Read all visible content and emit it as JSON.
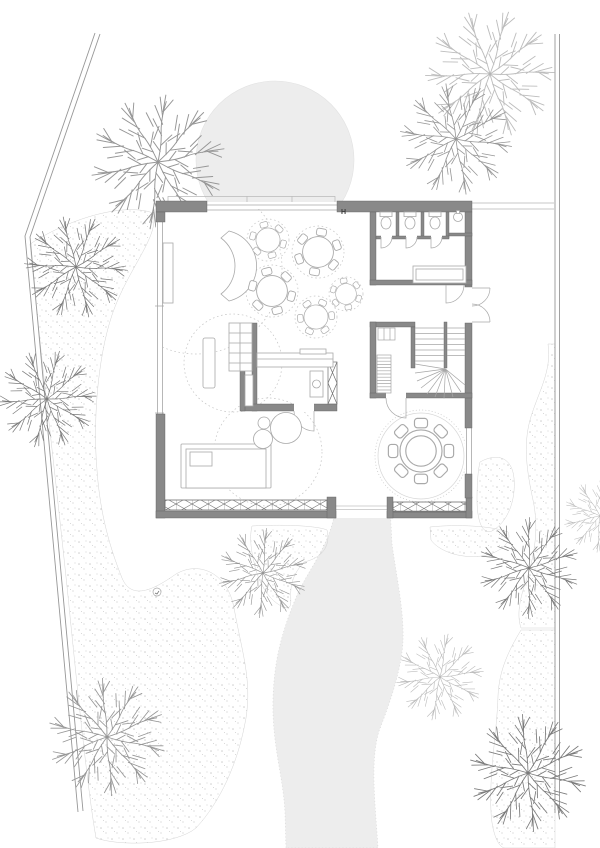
{
  "meta": {
    "drawing_type": "architectural ground-floor site plan",
    "visible_text": [
      "H"
    ]
  },
  "palette": {
    "paper": "#ffffff",
    "boundary": "#979797",
    "line": "#a6a6a6",
    "line_light": "#b5b5b5",
    "wall_fill": "#898989",
    "wall_edge": "#5f5f5f",
    "furniture": "#a9a9a9",
    "rug_dash": "#c4c4c4",
    "ground_fill": "#ededed",
    "stipple_dot": "#c9c9c9",
    "tree_light": "#bdbdbd",
    "tree_medium": "#969696",
    "tree_dark": "#7a7a7a",
    "label": "#3c3c3c"
  },
  "plan": {
    "marker_h": "H",
    "site": {
      "boundary_west": "angled double property line",
      "boundary_east": "vertical double property line",
      "entry_court": "grey circular forecourt at north facade",
      "garden_path": "grey winding path leaving south facade",
      "planting_beds": 6,
      "trees": [
        {
          "x": 158,
          "y": 162,
          "tone": "medium"
        },
        {
          "x": 490,
          "y": 74,
          "tone": "light"
        },
        {
          "x": 456,
          "y": 139,
          "tone": "medium"
        },
        {
          "x": 76,
          "y": 267,
          "tone": "dark"
        },
        {
          "x": 47,
          "y": 399,
          "tone": "dark"
        },
        {
          "x": 263,
          "y": 573,
          "tone": "medium"
        },
        {
          "x": 107,
          "y": 737,
          "tone": "medium"
        },
        {
          "x": 440,
          "y": 677,
          "tone": "light"
        },
        {
          "x": 529,
          "y": 568,
          "tone": "dark"
        },
        {
          "x": 528,
          "y": 773,
          "tone": "dark"
        },
        {
          "x": 600,
          "y": 516,
          "tone": "light"
        }
      ]
    },
    "building": {
      "rooms": [
        "lounge with round tables and crescent sofa",
        "wc group with three stalls and sink",
        "entrance with outward double doors",
        "staircase with winder treads",
        "pantry shelving",
        "kitchen block with closet and counter",
        "bedroom corner with bed",
        "round dining room with circular rug"
      ],
      "tables_with_chairs": [
        {
          "x": 268,
          "y": 240,
          "seats": 6
        },
        {
          "x": 318,
          "y": 252,
          "seats": 6
        },
        {
          "x": 272,
          "y": 291,
          "seats": 6
        },
        {
          "x": 346,
          "y": 294,
          "seats": 4
        },
        {
          "x": 316,
          "y": 317,
          "seats": 6
        },
        {
          "x": 421,
          "y": 451,
          "seats": 8
        }
      ]
    }
  }
}
